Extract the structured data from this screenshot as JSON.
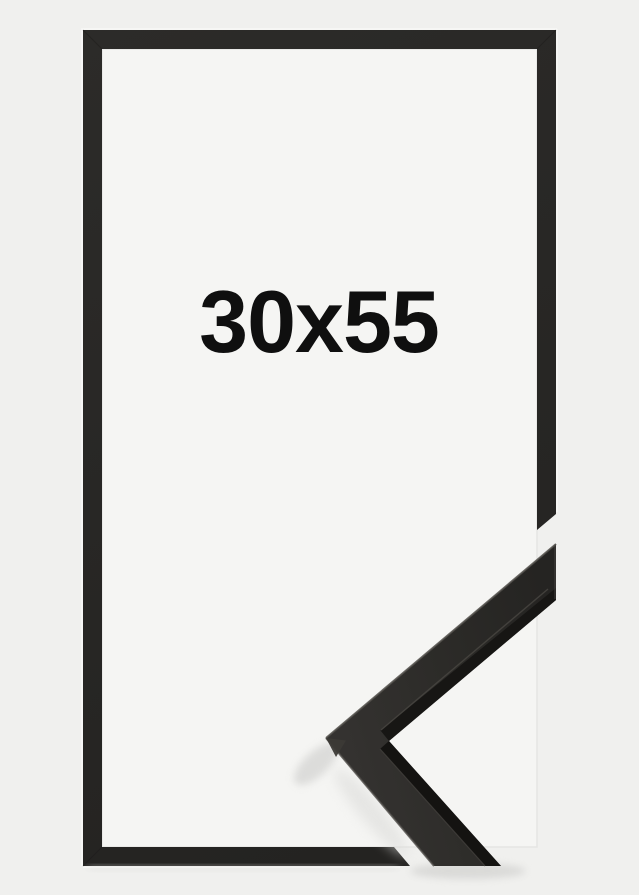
{
  "image": {
    "size_label": "30x55",
    "colors": {
      "background": "#f0f0ee",
      "frame_opening": "#f5f5f3",
      "frame_black": "#282724",
      "moulding_face": "#2e2c2a",
      "moulding_side": "#171614",
      "label_text": "#0f0f0f"
    }
  }
}
